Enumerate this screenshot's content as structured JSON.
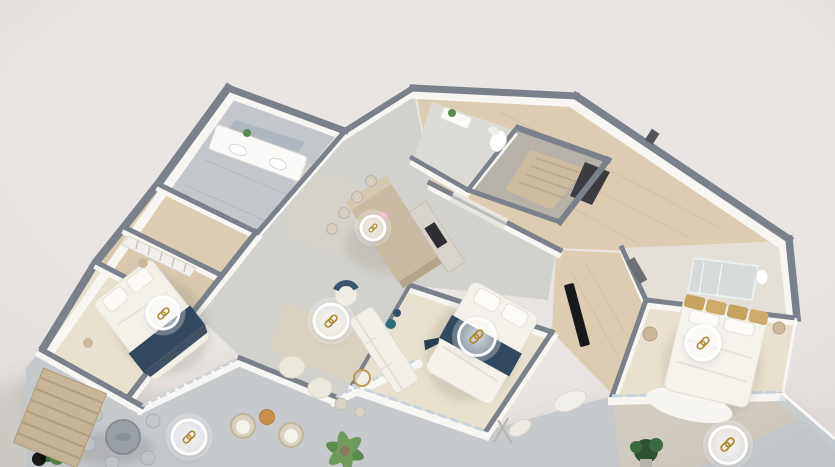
{
  "scene": {
    "kind": "3d-dollhouse-floorplan-render",
    "hotspot_icon": "chain-link-icon"
  },
  "colors": {
    "background": "#e9e5e2",
    "background_edge": "#ded9d6",
    "wall_top": "#7a818b",
    "wall_face": "#f7f6f3",
    "wood_floor": "#dccdb2",
    "pale_floor": "#e9e1d0",
    "tile_floor": "#c3c7cb",
    "concrete_floor": "#d1d1cd",
    "terrace_floor": "#c6cacd",
    "island": "#c9bba2",
    "island_side": "#b3a48a",
    "navy": "#31485e",
    "teal": "#2a6d7c",
    "gold": "#ae8c36",
    "plant": "#5d8a4e",
    "plant_dark": "#2f5233",
    "wood_accent": "#c98e4d",
    "glass": "#c8d4dc"
  },
  "hotspots": [
    {
      "id": "hotspot-kitchen-island",
      "icon": "chain-link-icon",
      "x": 373,
      "y": 228,
      "d": 27
    },
    {
      "id": "hotspot-bedroom-left",
      "icon": "chain-link-icon",
      "x": 163,
      "y": 313,
      "d": 35
    },
    {
      "id": "hotspot-living-area",
      "icon": "chain-link-icon",
      "x": 331,
      "y": 321,
      "d": 37
    },
    {
      "id": "hotspot-bedroom-middle",
      "icon": "chain-link-icon",
      "x": 477,
      "y": 337,
      "d": 40
    },
    {
      "id": "hotspot-bedroom-right",
      "icon": "chain-link-icon",
      "x": 703,
      "y": 343,
      "d": 37
    },
    {
      "id": "hotspot-terrace-left",
      "icon": "chain-link-icon",
      "x": 189,
      "y": 437,
      "d": 37
    },
    {
      "id": "hotspot-terrace-right",
      "icon": "chain-link-icon",
      "x": 728,
      "y": 445,
      "d": 40
    }
  ]
}
